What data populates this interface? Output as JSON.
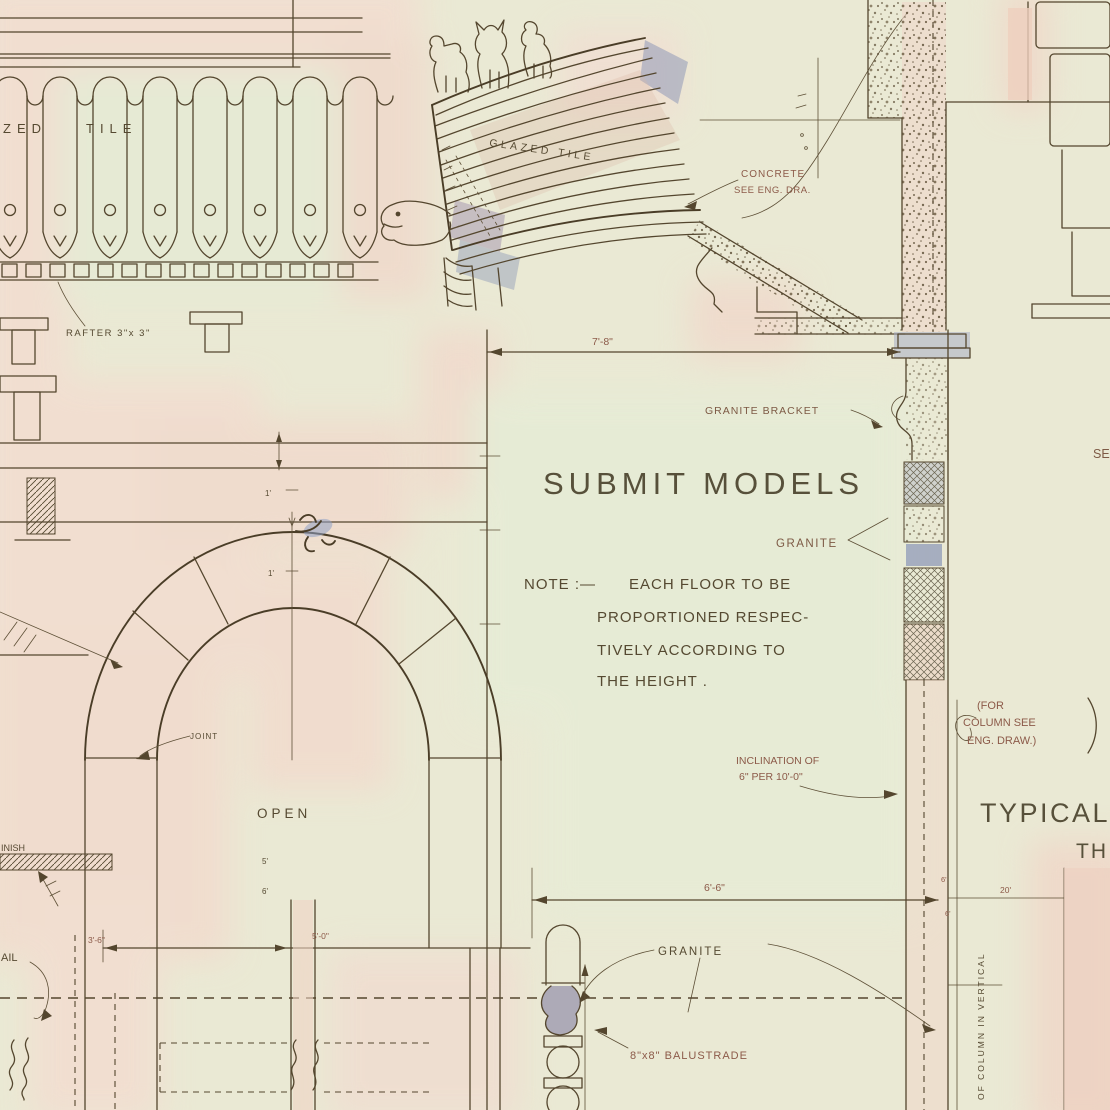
{
  "document_type": "architectural working drawing (hand-drawn detail sheet)",
  "labels": {
    "glazed_left_a": "ZED",
    "glazed_left_b": "TILE",
    "rafter": "RAFTER 3\"x 3\"",
    "glazed_roof": "GLAZED TILE",
    "concrete_a": "CONCRETE",
    "concrete_b": "SEE ENG. DRA.",
    "dim_7_8": "7'-8\"",
    "granite_bracket": "GRANITE BRACKET",
    "submit_models": "SUBMIT MODELS",
    "granite_upper": "GRANITE",
    "note_a": "NOTE :—",
    "note_b": "EACH FLOOR TO BE",
    "note_c": "PROPORTIONED RESPEC-",
    "note_d": "TIVELY ACCORDING TO",
    "note_e": "THE HEIGHT .",
    "for_col_a": "(FOR",
    "for_col_b": "COLUMN SEE",
    "for_col_c": "ENG. DRAW.)",
    "incl_a": "INCLINATION OF",
    "incl_b": "6\" PER 10'-0\"",
    "typical": "TYPICAL",
    "typical_b": "TH",
    "dim_6_6": "6'-6\"",
    "granite_lower": "GRANITE",
    "balustrade": "8\"x8\" BALUSTRADE",
    "joint": "JOINT",
    "open": "OPEN",
    "finish_cut": "INISH",
    "rail_cut": "AIL",
    "see_cut": "SE",
    "dim_20": "20'",
    "dim_6_a": "6'",
    "dim_6_b": "6'",
    "dim_3_6": "3'-6\"",
    "dim_5_0": "5'-0\"",
    "dim_5_s": "5'",
    "dim_6_s": "6'",
    "dim_1_a": "1'",
    "dim_1_b": "1'",
    "col_vertical": "OF COLUMN IN VERTICAL"
  },
  "colors": {
    "paper_green": "#eae9d4",
    "paper_pink": "#f3dcd0",
    "ink": "#54462e",
    "accent_red_brown": "#8c5a49",
    "blue_wash": "#95a0c0",
    "purple_wash": "#9b8aab",
    "tan_wash": "#d9b9a4"
  }
}
